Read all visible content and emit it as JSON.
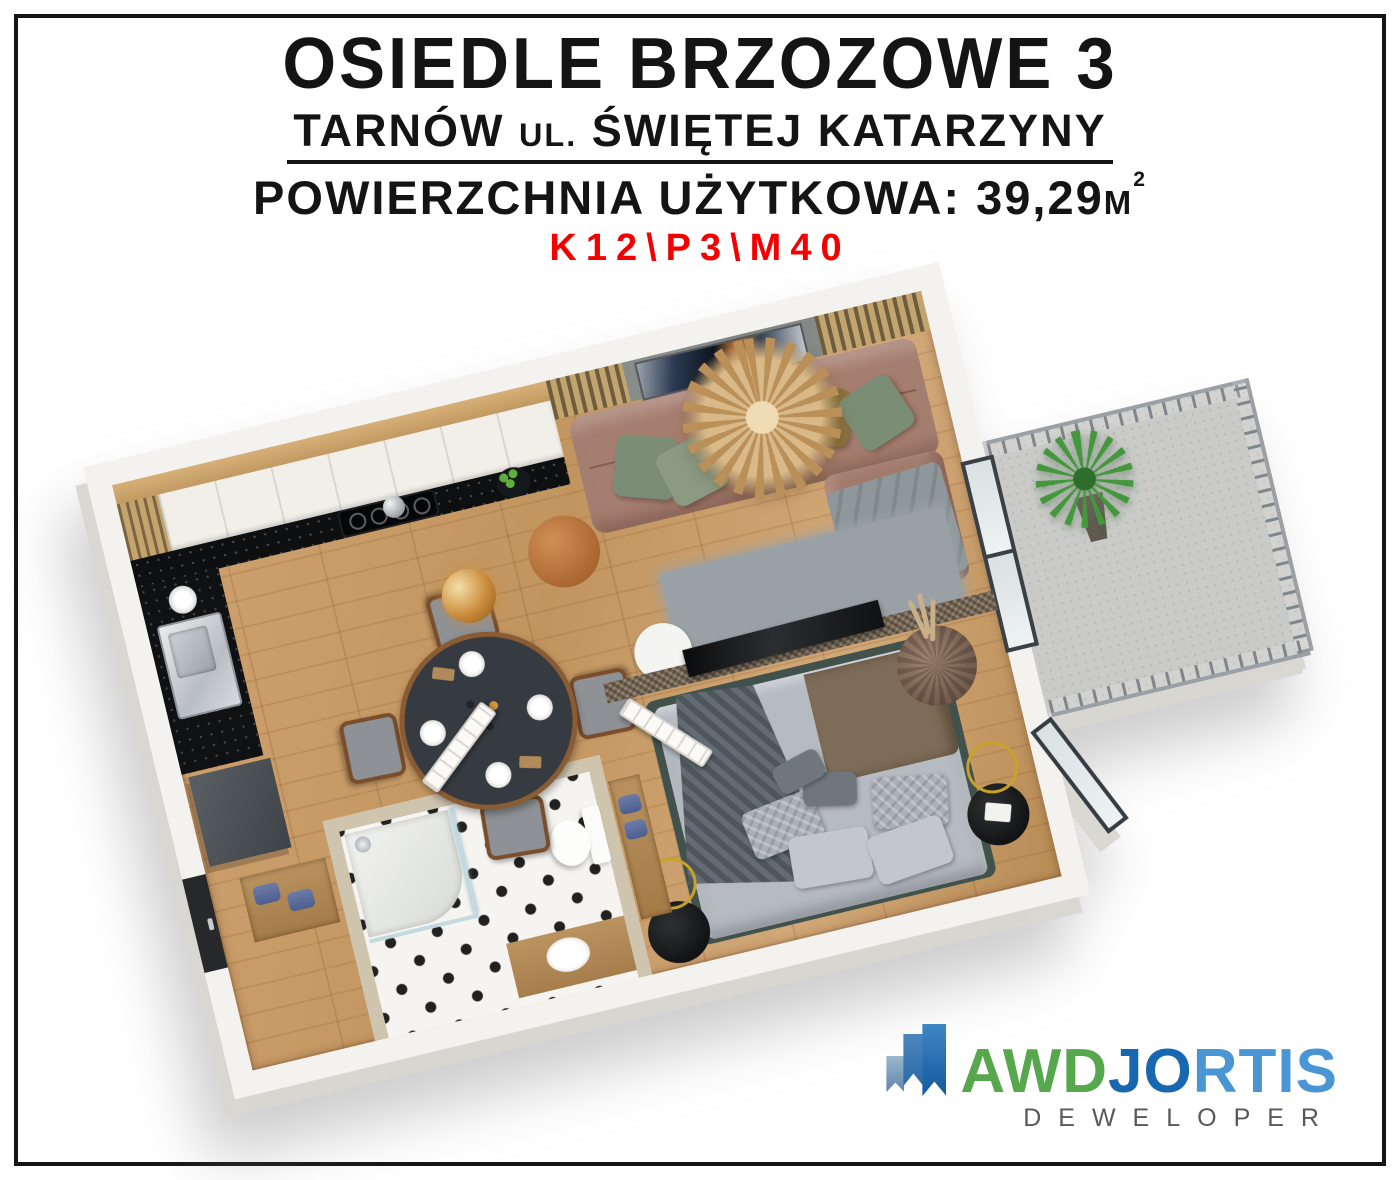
{
  "header": {
    "title": "OSIEDLE BRZOZOWE 3",
    "address": {
      "city": "TARNÓW",
      "prefix": "UL.",
      "street": "ŚWIĘTEJ KATARZYNY"
    },
    "area": {
      "label": "POWIERZCHNIA UŻYTKOWA:",
      "value": "39,29",
      "unit": "M",
      "sup": "2"
    },
    "unit_code": "K12\\P3\\M40"
  },
  "logo": {
    "brand_part1": "AWD",
    "brand_part2": "JO",
    "brand_part3": "RTIS",
    "subtitle": "DEWELOPER",
    "icon": "stepped-flags-growth-icon"
  },
  "colors": {
    "unit_code_red": "#f40000",
    "logo_green": "#57a74d",
    "logo_blue_dark": "#1767b1",
    "logo_blue_light": "#4a96d5",
    "logo_subtitle_gray": "#58595b",
    "wall_white": "#f3f2ef",
    "wood_floor": "#c79a66",
    "kitchen_counter_black": "#0e0f10",
    "sofa_brown": "#a67e6f",
    "pillow_green": "#7c8d75",
    "pillow_olive": "#8a7340",
    "bed_gray": "#b6bbc1",
    "rattan_partition": "#7d6c58",
    "balcony_concrete": "#cacbc8",
    "bath_tile_black": "#23211f",
    "towel_blue": "#5a6b9c"
  }
}
